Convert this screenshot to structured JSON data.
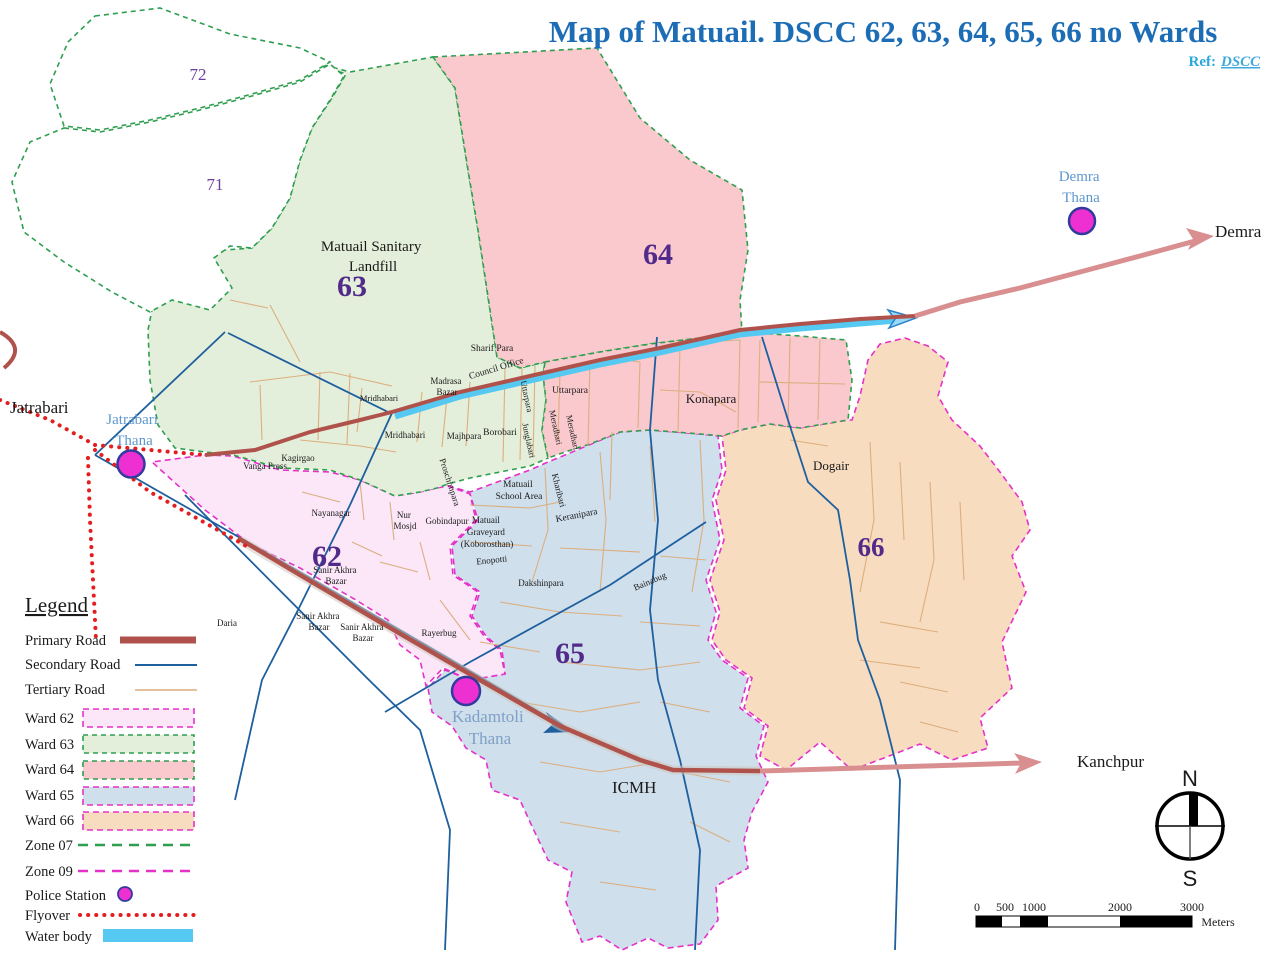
{
  "title": {
    "text": "Map of Matuail. DSCC 62, 63, 64, 65, 66 no Wards"
  },
  "ref": {
    "prefix": "Ref:",
    "link": "DSCC"
  },
  "map": {
    "ward_numbers": {
      "w62": "62",
      "w63": "63",
      "w64": "64",
      "w65": "65",
      "w66": "66"
    },
    "zone_numbers": {
      "z71": "71",
      "z72": "72"
    },
    "labels": {
      "jatrabari": "Jatrabari",
      "demra": "Demra",
      "kanchpur": "Kanchpur",
      "icmh": "ICMH",
      "landfill": [
        "Matuail Sanitary",
        "Landfill"
      ],
      "konapara": "Konapara",
      "dogair": "Dogair",
      "vanga_press": "Vanga Press",
      "kagirgao": "Kagirgao",
      "daria": "Daria",
      "nayanagar": "Nayanagar",
      "sanir_akhra_bazar": [
        "Sanir Akhra",
        "Bazar"
      ],
      "nur_mosjd": [
        "Nur",
        "Mosjd"
      ],
      "gobindapur": "Gobindapur",
      "rayerbug": "Rayerbug",
      "graveyard": [
        "Matuail",
        "Graveyard",
        "(Koborosthan)"
      ],
      "enopotti": "Enopotti",
      "dakshinpara": "Dakshinpara",
      "school": [
        "Matuail",
        "School Area"
      ],
      "keranipara": "Keranipara",
      "kharibari": "Kharibari",
      "bainabug": "Bainabug",
      "mridhabari": "Mridhabari",
      "majhpara": "Majhpara",
      "borobari": "Borobari",
      "junglabari": "Junglabari",
      "uttarpara": "Uttarpara",
      "meradhari": "Meradhari",
      "sharif_para": "Sharif Para",
      "council_office": "Council Office",
      "madrasa_bazar": [
        "Madrasa",
        "Bazar"
      ],
      "proschimpara": "Proschimpara"
    },
    "police_stations": {
      "jatrabari": [
        "Jatrabari",
        "Thana"
      ],
      "kadamtoli": [
        "Kadamtoli",
        "Thana"
      ],
      "demra": [
        "Demra",
        "Thana"
      ]
    },
    "colors": {
      "ward62_fill": "#fbe7f8",
      "ward63_fill": "#e4efdb",
      "ward64_fill": "#f9c9cd",
      "ward65_fill": "#cfdfec",
      "ward66_fill": "#f8dcc0",
      "zone07_border": "#2e9e4f",
      "zone09_border": "#e531c8",
      "primary_road": "#b0524c",
      "secondary_road": "#1e5f9e",
      "tertiary_road": "#dcae7e",
      "flyover": "#e41e1e",
      "water": "#55c9f1",
      "police": "#ee2fd2",
      "ward_number": "#522a8a",
      "title": "#1d6db6"
    }
  },
  "legend": {
    "heading": "Legend",
    "items": [
      {
        "label": "Primary Road"
      },
      {
        "label": "Secondary Road"
      },
      {
        "label": "Tertiary Road"
      },
      {
        "label": "Ward 62"
      },
      {
        "label": "Ward 63"
      },
      {
        "label": "Ward 64"
      },
      {
        "label": "Ward 65"
      },
      {
        "label": "Ward 66"
      },
      {
        "label": "Zone 07"
      },
      {
        "label": "Zone 09"
      },
      {
        "label": "Police Station"
      },
      {
        "label": "Flyover"
      },
      {
        "label": "Water body"
      }
    ]
  },
  "scale_bar": {
    "ticks": [
      "0",
      "500",
      "1000",
      "2000",
      "3000"
    ],
    "unit": "Meters"
  },
  "compass": {
    "north": "N",
    "south": "S"
  }
}
